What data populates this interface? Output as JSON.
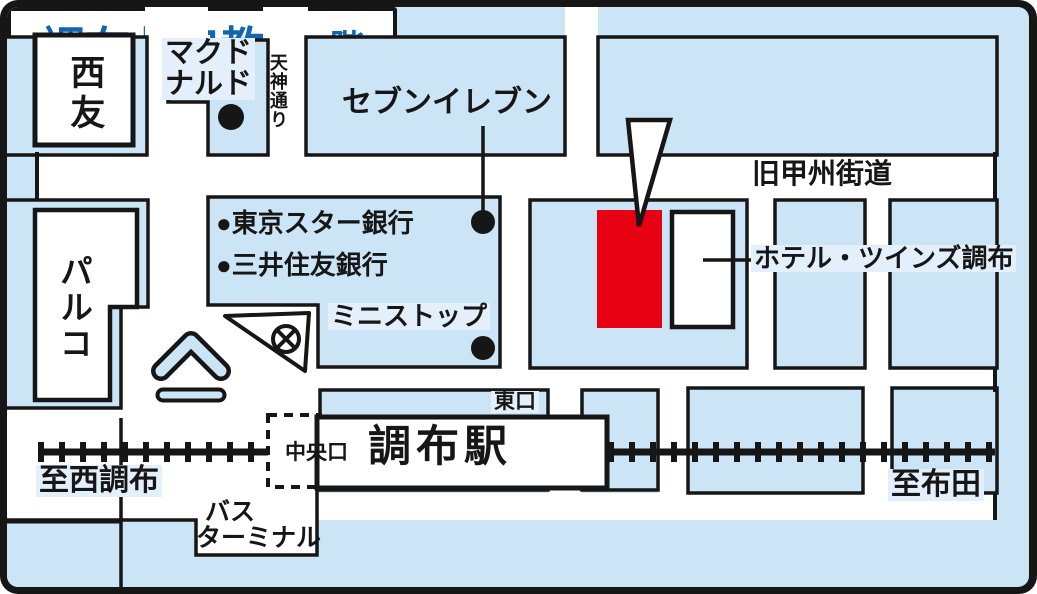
{
  "map": {
    "colors": {
      "background_blue": "#cbe4f6",
      "label_highlight": "#e3effa",
      "marker_red": "#e60012",
      "title_blue": "#1465af",
      "ink": "#161616"
    },
    "title": {
      "classroom_name": "調布北口教室",
      "classroom_floor": "1階"
    },
    "roads": {
      "kyu_koshu_kaido": "旧甲州街道",
      "tenjin_dori": "天神通り"
    },
    "station": {
      "name": "調布駅",
      "central_exit": "中央口",
      "east_exit": "東口",
      "bus_terminal_line1": "バス",
      "bus_terminal_line2": "ターミナル",
      "to_west": "至西調布",
      "to_east": "至布田"
    },
    "landmarks": {
      "seiyu": "西友",
      "parco": "パルコ",
      "mcdonalds_line1": "マクド",
      "mcdonalds_line2": "ナルド",
      "seven_eleven": "セブンイレブン",
      "tokyo_star_bank": "●東京スター銀行",
      "sumitomo_mitsui_bank": "●三井住友銀行",
      "ministop": "ミニストップ",
      "hotel_twins_chofu": "ホテル・ツインズ調布"
    }
  }
}
